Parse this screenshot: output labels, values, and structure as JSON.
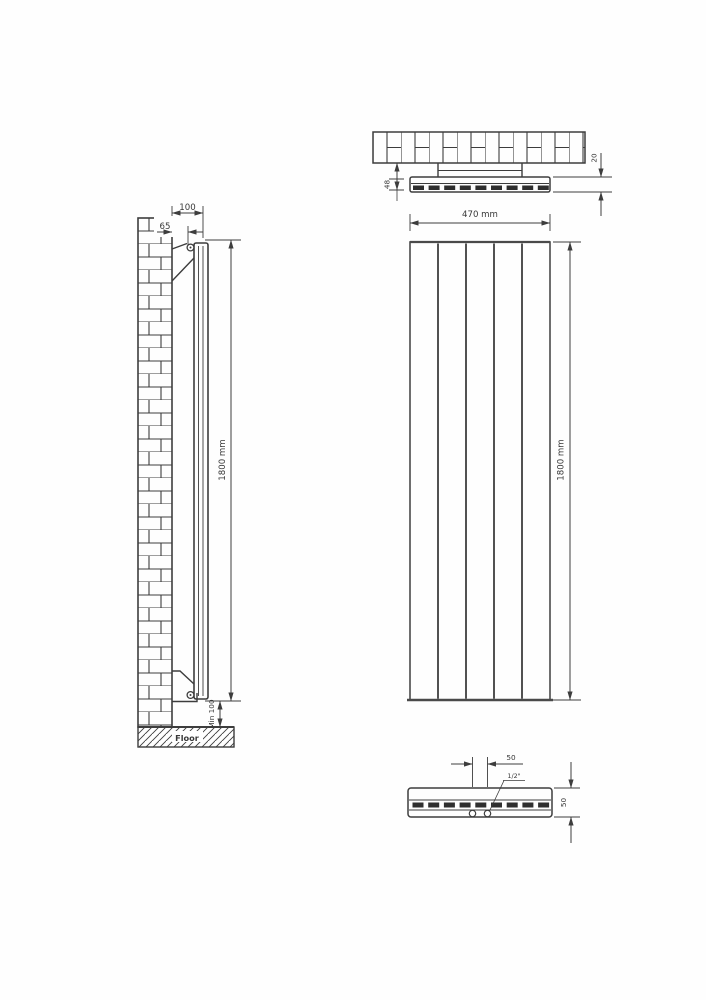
{
  "colors": {
    "line": "#3d3d3d",
    "background": "#ffffff"
  },
  "side_view": {
    "dim_total_depth": "100",
    "dim_bracket_depth": "65",
    "dim_height": "1800 mm",
    "dim_floor_clearance": "Min 100",
    "floor_label": "Floor"
  },
  "top_view": {
    "dim_wall_gap": "48",
    "dim_panel_thickness": "20"
  },
  "front_view": {
    "dim_width": "470 mm",
    "dim_height": "1800 mm",
    "panel_count": 5
  },
  "bottom_view": {
    "dim_valve_spacing": "50",
    "valve_thread": "1/2\"",
    "dim_depth": "50"
  }
}
